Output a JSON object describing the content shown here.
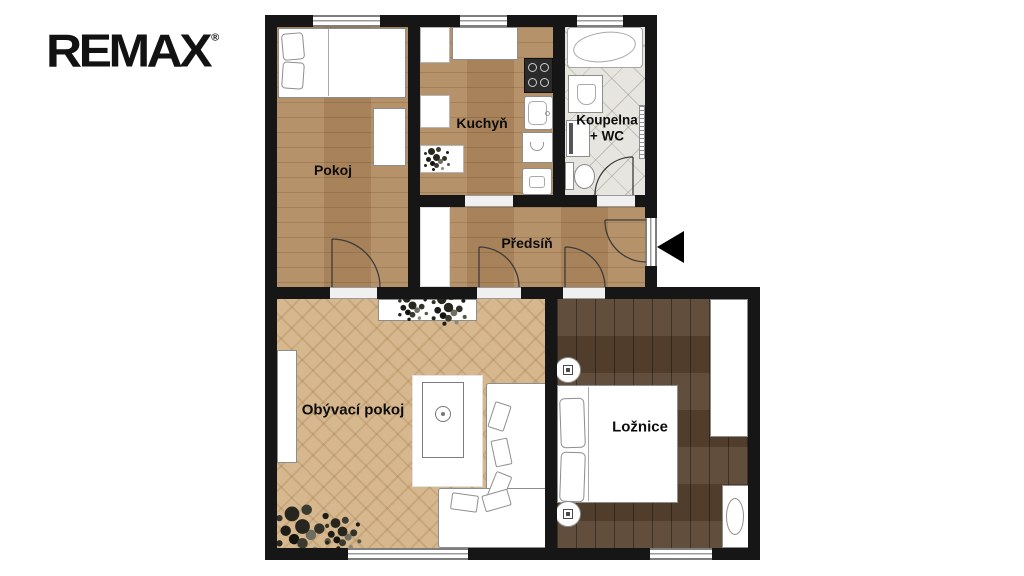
{
  "logo": {
    "brand": "REMAX",
    "registered": "®"
  },
  "rooms": {
    "pokoj": {
      "label": "Pokoj"
    },
    "kuchyn": {
      "label": "Kuchyň"
    },
    "koupelna": {
      "label_line1": "Koupelna",
      "label_line2": "+ WC"
    },
    "predsin": {
      "label": "Předsíň"
    },
    "obyvaci": {
      "label": "Obývací pokoj"
    },
    "loznice": {
      "label": "Ložnice"
    }
  },
  "colors": {
    "background": "#ffffff",
    "wall": "#161616",
    "wood_medium": "#b18a5f",
    "wood_herringbone_light": "#d7b88e",
    "wood_dark": "#5a4431",
    "bathroom_tile": "#e7e5df",
    "logo_text": "#121212",
    "entrance_arrow": "#000000",
    "label_text": "#0c0c0c"
  },
  "icons": {
    "entrance_arrow": "left-pointing-triangle",
    "plants": "dark-foliage-cluster"
  }
}
